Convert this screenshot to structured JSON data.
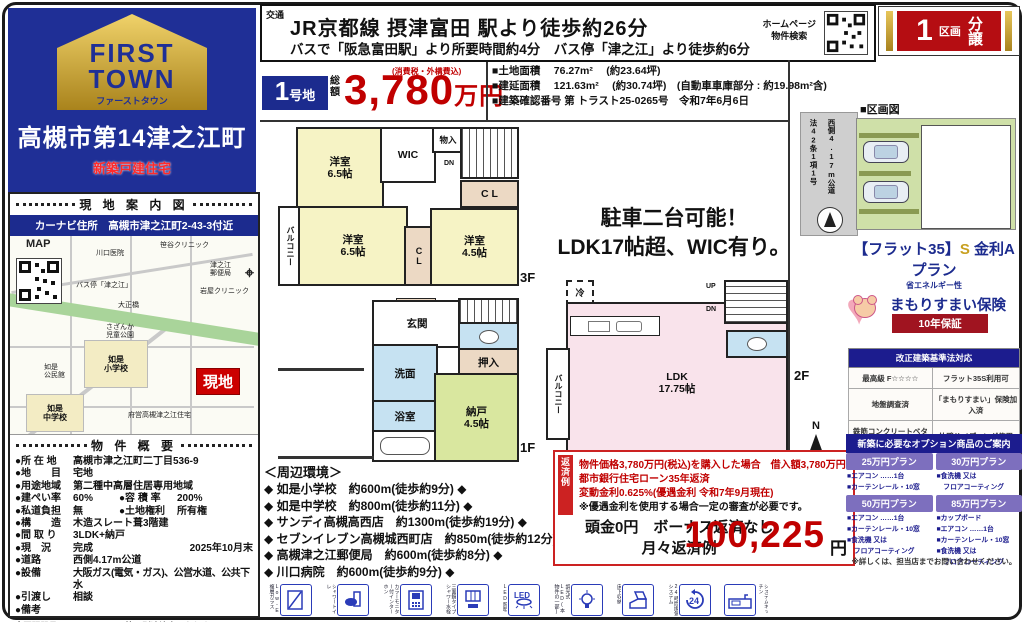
{
  "accent_colors": {
    "navy": "#1c2b8e",
    "red": "#c00000",
    "banner_red": "#b50d12",
    "gold": "#c8a020",
    "plan_purple": "#7d6fbe"
  },
  "brand": {
    "logo_line1": "FIRST",
    "logo_line2": "TOWN",
    "logo_kana": "ファーストタウン",
    "title": "高槻市第14津之江町",
    "subtitle": "新築戸建住宅"
  },
  "transport": {
    "label": "交通",
    "line1": "JR京都線 摂津富田 駅より徒歩約26分",
    "line2": "バスで「阪急富田駅」より所要時間約4分　バス停「津之江」より徒歩約6分"
  },
  "homepage_search": {
    "line1": "ホームページ",
    "line2": "物件検索"
  },
  "lot_banner": {
    "number": "1",
    "kukaku": "区画",
    "bunjo": "分譲"
  },
  "price": {
    "lot_num": "1",
    "lot_suffix": "号地",
    "label": "総額",
    "note": "(消費税・外構費込)",
    "amount": "3,780",
    "unit": "万円"
  },
  "land_info": {
    "row1": "■土地面積　 76.27m²　 (約23.64坪)",
    "row2": "■建延面積　 121.63m²　 (約30.74坪)　(自動車車庫部分 : 約19.98m²含)",
    "row3": "■建築確認番号 第 トラスト25-0265号　令和7年6月6日"
  },
  "guide": {
    "header": "現 地 案 内 図",
    "carnav": "カーナビ住所　高槻市津之江町2-43-3付近"
  },
  "map": {
    "label": "MAP",
    "genchi": "現地",
    "l1": "川口医院",
    "l2": "笹谷クリニック",
    "l3": "津之江\n郵便局",
    "l4": "岩屋クリニック",
    "l5": "バス停「津之江」",
    "l6": "大正橋",
    "l7": "さざんか\n児童公園",
    "l8": "如是\n小学校",
    "l9": "如是\n公民館",
    "l10": "如是\n中学校",
    "l11": "府営高槻津之江住宅"
  },
  "overview": {
    "header": "物 件 概 要",
    "rows": [
      {
        "l": "●所 在 地",
        "v": "高槻市津之江町二丁目536-9"
      },
      {
        "l": "●地　　目",
        "v": "宅地"
      },
      {
        "l": "●用途地域",
        "v": "第二種中高層住居専用地域"
      },
      {
        "l": "●建ぺい率",
        "v": "60%",
        "l2": "●容 積 率",
        "v2": "200%"
      },
      {
        "l": "●私道負担",
        "v": "無",
        "l2": "●土地権利",
        "v2": "所有権"
      },
      {
        "l": "●構　　造",
        "v": "木造スレート葺3階建"
      },
      {
        "l": "●間 取 り",
        "v": "3LDK+納戸"
      },
      {
        "l": "●現　況",
        "v": "完成",
        "r": "2025年10月末"
      },
      {
        "l": "●道路",
        "v": "西側4.17m公道"
      },
      {
        "l": "●設備",
        "v": "大阪ガス(電気・ガス)、公営水道、公共下水"
      },
      {
        "l": "●引渡し",
        "v": "相談"
      },
      {
        "l": "●備考",
        "v": ""
      }
    ],
    "note1": "※照明器具、カーテンレール等は別途注文となります。",
    "note2": "CATV時、お客様負担となります。外構工事は、当社標準"
  },
  "floorplan": {
    "catch_line1": "駐車二台可能！",
    "catch_line2": "LDK17帖超、WIC有り。",
    "f3": {
      "label": "3F",
      "balcony": "バルコニー",
      "room1": "洋室\n6.5帖",
      "wic": "WIC",
      "monoire": "物入",
      "dn": "DN",
      "cl1": "C L",
      "room2": "洋室\n6.5帖",
      "cl2": "CL",
      "room3": "洋室\n4.5帖"
    },
    "f2": {
      "label": "2F",
      "reizo": "冷",
      "balcony": "バルコニー",
      "up": "UP",
      "dn": "DN",
      "ldk": "LDK\n17.75帖"
    },
    "f1": {
      "label": "1F",
      "genkan": "玄関",
      "up": "UP",
      "oshiire": "押入",
      "senmen": "洗面",
      "yokushitsu": "浴室",
      "nando": "納戸\n4.5帖"
    }
  },
  "surroundings": {
    "header": "＜周辺環境＞",
    "items": [
      "◆ 如是小学校　約600m(徒歩約9分) ◆",
      "◆ 如是中学校　約800m(徒歩約11分) ◆",
      "◆ サンディ高槻高西店　約1300m(徒歩約19分) ◆",
      "◆ セブンイレブン高槻城西町店　約850m(徒歩約12分) ◆",
      "◆ 高槻津之江郵便局　約600m(徒歩約8分) ◆",
      "◆ 川口病院　約600m(徒歩約9分) ◆"
    ]
  },
  "loan": {
    "tab": "返済例",
    "line1": "物件価格3,780万円(税込)を購入した場合　借入額3,780万円",
    "line2": "都市銀行住宅ローン35年返済",
    "line3": "変動金利0.625%(優遇金利 令和7年9月現在)",
    "line4": "※優遇金利を使用する場合一定の審査が必要です。",
    "down": "頭金0円　ボーナス返済なし",
    "monthly_label": "月々返済例",
    "amount": "100,225",
    "unit": "円"
  },
  "right": {
    "kukakuzu_header": "■区画図",
    "road_line1": "法42条1項1号",
    "road_line2": "西側4.17m公道",
    "flat35_main": "【フラット35】",
    "flat35_s": "S",
    "flat35_plan": " 金利Aプラン",
    "flat35_sub": "省エネルギー性",
    "insurance_title": "まもりすまい保険",
    "insurance_warranty": "10年保証",
    "spec_header": "改正建築基準法対応",
    "spec_rows": [
      [
        "最高級 F☆☆☆☆",
        "フラット35S利用可"
      ],
      [
        "地盤調査済",
        "「まもりすまい」保険加入済"
      ],
      [
        "鉄筋コンクリートベタ基礎",
        "外壁サイディング使用"
      ]
    ],
    "options_header": "新築に必要なオプション商品のご案内",
    "plans": [
      {
        "name": "25万円プラン",
        "lines": [
          "■エアコン ……1台",
          "■カーテンレール・10窓"
        ]
      },
      {
        "name": "30万円プラン",
        "lines": [
          "■食洗機 又は",
          "　フロアコーティング"
        ]
      },
      {
        "name": "50万円プラン",
        "lines": [
          "■エアコン ……1台",
          "■カーテンレール・10窓",
          "■食洗機 又は",
          "　フロアコーティング"
        ]
      },
      {
        "name": "85万円プラン",
        "lines": [
          "■カップボード",
          "■エアコン ……1台",
          "■カーテンレール・10窓",
          "■食洗機 又は",
          "　フロアコーティング"
        ]
      }
    ],
    "plans_note": "※詳しくは、担当店までお問い合わせください。"
  },
  "equip_icons": [
    {
      "label": "Low-E複層ガラス"
    },
    {
      "label": "シャワートイレ"
    },
    {
      "label": "カラーモニター付インターホン"
    },
    {
      "label": "三面鏡タイプシャワー水栓"
    },
    {
      "label": "LED照明"
    },
    {
      "label": "調光式LED(本物件の一部)"
    },
    {
      "label": "床下収納"
    },
    {
      "label": "24時間換気システム"
    },
    {
      "label": "システムキッチン"
    }
  ]
}
